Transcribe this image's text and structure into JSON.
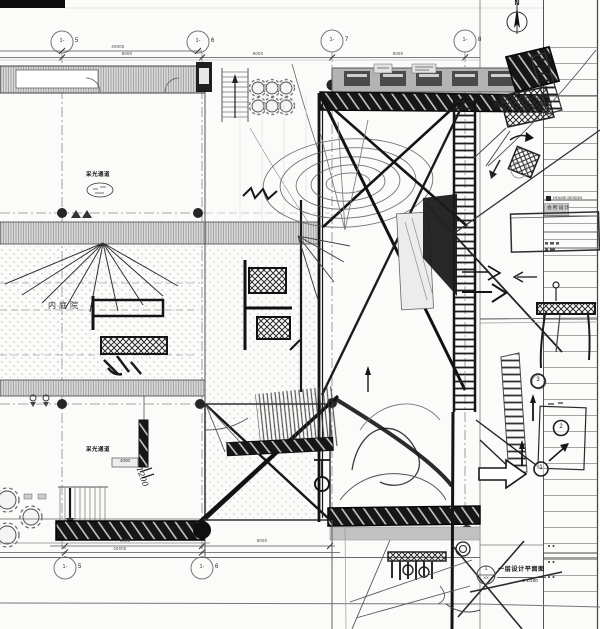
{
  "sheet": {
    "north_label": "N",
    "grid_bubble_prefix": "1-",
    "grid_top": [
      "5",
      "6",
      "7",
      "8"
    ],
    "grid_bottom": [
      "5",
      "6"
    ],
    "dims": {
      "top_overall": "40000",
      "top_bay_1": "9000",
      "top_bay_2": "9000",
      "top_bay_3": "9000",
      "bottom_bay_1": "9000",
      "bottom_bay_2": "9000",
      "bottom_overall": "40000"
    },
    "labels": {
      "courtyard": "内庭院",
      "light_channel_top": "采光通道",
      "light_channel_bottom": "采光通道",
      "tag_4000": "4000",
      "handwritten_1200": "1200"
    },
    "title_block": {
      "en": "HOUSE DESIGN",
      "cn": "会所设计"
    },
    "caption": {
      "title": "一层设计平面图",
      "scale": "S 1/100",
      "ref_top": "1",
      "ref_bottom": "XX"
    },
    "sequence": [
      "1",
      "2",
      "3"
    ],
    "colors": {
      "paper": "#fbfbf9",
      "cad_line": "#777777",
      "sketch_ink": "#141414",
      "band_gray": "#b3b3b3"
    }
  }
}
